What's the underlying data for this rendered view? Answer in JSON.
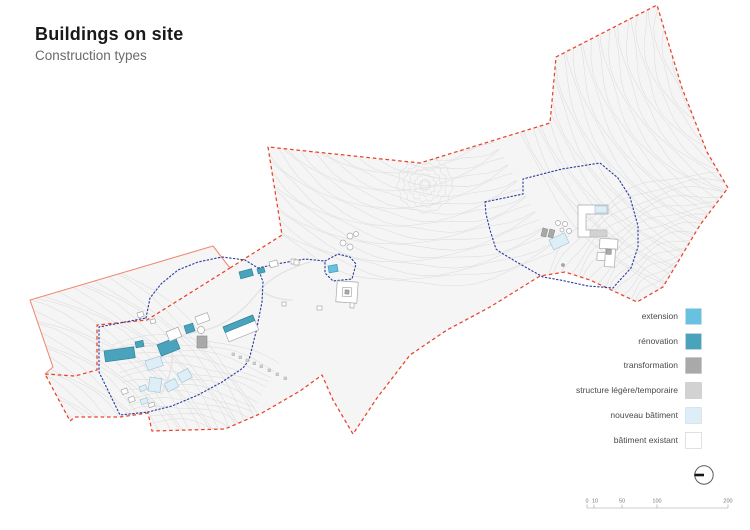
{
  "header": {
    "title": "Buildings on site",
    "subtitle": "Construction types"
  },
  "legend": {
    "items": [
      {
        "label": "extension",
        "color": "#66c2e0"
      },
      {
        "label": "rénovation",
        "color": "#4aa3bd"
      },
      {
        "label": "transformation",
        "color": "#a9a9a9"
      },
      {
        "label": "structure légère/temporaire",
        "color": "#d2d2d2"
      },
      {
        "label": "nouveau bâtiment",
        "color": "#ddeef7"
      },
      {
        "label": "bâtiment existant",
        "color": "#ffffff"
      }
    ]
  },
  "map": {
    "boundary_colors": {
      "site_perimeter": "#e8432a",
      "site_perimeter_solid": "#ef8b74",
      "zone_boundary": "#2f3f9e"
    },
    "contour_color": "#dcdcdc"
  },
  "scalebar": {
    "labels": [
      "0",
      "10",
      "50",
      "100",
      "200"
    ]
  }
}
